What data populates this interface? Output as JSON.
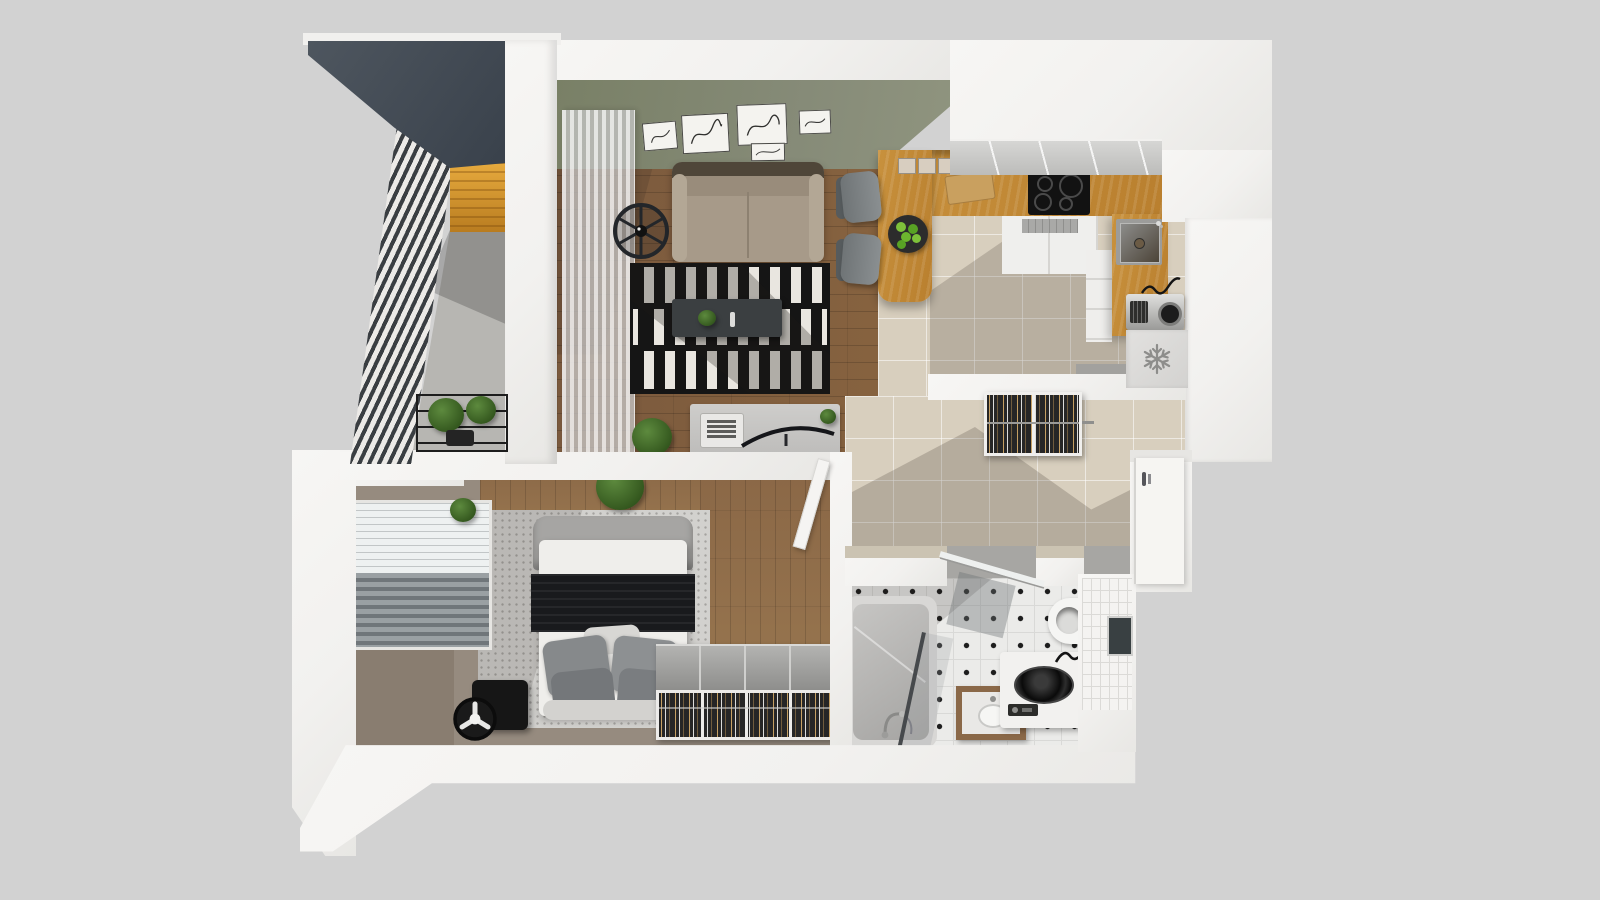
{
  "scene": {
    "title": "One-bedroom apartment 3D floor plan, top-down dollhouse render",
    "view": "top-down axonometric",
    "background": "light gray studio backdrop"
  },
  "rooms": {
    "balcony": {
      "name": "Balcony",
      "objects": [
        "dark canopy roof",
        "louvered privacy screen",
        "orange wood-slat wall",
        "concrete floor",
        "plant stand with two potted plants",
        "white pillar"
      ]
    },
    "living_room": {
      "name": "Living room",
      "objects": [
        "olive feature wall",
        "five framed line-art pictures",
        "sheer ribbed curtain",
        "black ceiling fan",
        "beige two-seat sofa",
        "black and white striped rug",
        "charcoal media console with plant and remote",
        "desk with laptop and curved monitor",
        "potted plant",
        "oak plank floor"
      ]
    },
    "kitchen": {
      "name": "Kitchen",
      "objects": [
        "U-shaped oak countertop",
        "gray upper cabinet run",
        "black induction cooktop with four burners",
        "undermount sink with faucet",
        "two gray bar stools",
        "plate of green apples",
        "wooden cutting board",
        "three storage boxes",
        "white base cabinets",
        "extractor grille",
        "silver coffee machine",
        "freezer floor marker with snowflake"
      ]
    },
    "hallway": {
      "name": "Hallway",
      "objects": [
        "beige tile floor",
        "open wardrobe with hanging clothes",
        "clothes rail",
        "white entry door with handle",
        "gray entry mat"
      ]
    },
    "bedroom": {
      "name": "Bedroom",
      "objects": [
        "bed with gray headboard",
        "white mattress",
        "black blanket",
        "four gray pillows",
        "light scatter pillow",
        "speckled area rug",
        "window with venetian blinds",
        "black floor fan",
        "open closet with hanger rows",
        "two houseplants",
        "taupe carpet",
        "white interior door ajar"
      ]
    },
    "bathroom": {
      "name": "Bathroom",
      "objects": [
        "white mosaic floor with black diamond accents",
        "gray bathtub with faucet",
        "glass shower screen",
        "wood-framed vanity sink",
        "top-load washing machine",
        "toilet",
        "subway tile wall",
        "dark wall mirror",
        "glass entry door"
      ]
    }
  },
  "icons": {
    "freezer_icon": "snowflake",
    "ceiling_fan_icon": "fan-rotor",
    "floor_fan_icon": "fan-rotor"
  },
  "colors": {
    "bg": "#d2d2d2",
    "wall": "#f3f2f0",
    "canopy-dark": "#39414b",
    "canopy-light": "#4e565f",
    "louver-light": "#eceae7",
    "louver-dark": "#3a3e42",
    "orange": "#dd9c33",
    "olive": "#868b78",
    "wood": "#7b5a3e",
    "wood-light": "#8a6746",
    "oak": "#c8913d",
    "tile": "#d8cfbe",
    "bath-tile": "#ebebe9",
    "concrete": "#b7b6b2",
    "taupe": "#968b7f",
    "rug-white": "#e9e6e0",
    "rug-black": "#151515",
    "sofa": "#a79a89",
    "blanket": "#191a1d",
    "snowflake": "#8d8d8b"
  }
}
